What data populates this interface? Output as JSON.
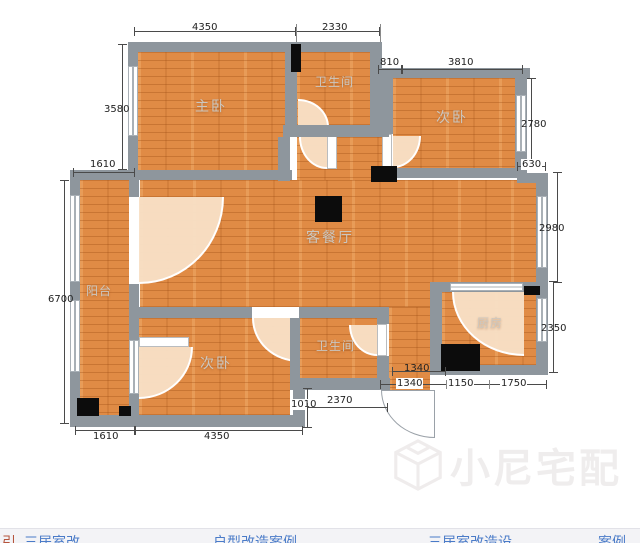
{
  "rooms": {
    "master": "主卧",
    "bath_top": "卫生间",
    "bedroom_top": "次卧",
    "living": "客餐厅",
    "balcony": "阳台",
    "bedroom_bottom": "次卧",
    "bath_bottom": "卫生间",
    "kitchen": "厨房"
  },
  "dimensions": {
    "top_master": "4350",
    "top_bath": "2330",
    "niche": "810",
    "top_bedroom": "3810",
    "left_master": "3580",
    "right_bedroom": "2780",
    "step_right": "630",
    "right_living": "2980",
    "balcony_top": "1610",
    "left_balcony": "6700",
    "right_kitchen": "2350",
    "entry_width_a": "1340",
    "entry_width_b": "1340",
    "hall_height": "1010",
    "hall_width": "2370",
    "kitchen_bottom_a": "1150",
    "kitchen_bottom_b": "1750",
    "bottom_balcony": "1610",
    "bottom_bedroom": "4350"
  },
  "watermark": {
    "text": "小尼宅配"
  },
  "footer": {
    "fragments": [
      "引",
      "三居室改",
      "户型改造案例",
      "三居室改造设",
      "案例"
    ]
  },
  "colors": {
    "floor": "#e08b45",
    "wall": "#8e969d",
    "dim_text": "#222222",
    "room_label": "#ccc7c0",
    "watermark": "#efeded",
    "link": "#4a7bc8"
  }
}
